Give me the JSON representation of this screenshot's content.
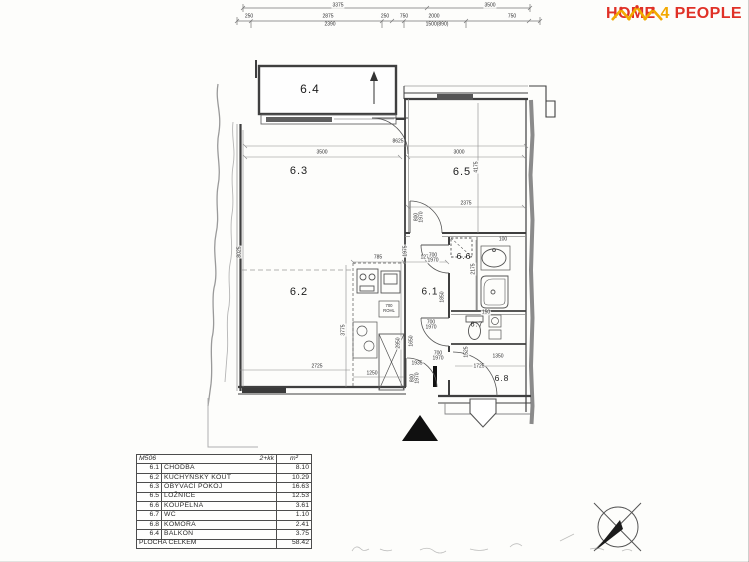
{
  "colors": {
    "logo_red": "#e03127",
    "logo_gold": "#f2a900",
    "wall": "#3f3f3f"
  },
  "logo": {
    "home": "HOME",
    "four": "4",
    "people": "PEOPLE"
  },
  "plan": {
    "rooms": [
      {
        "id": "6.4",
        "x": 310,
        "y": 89,
        "fs": 12
      },
      {
        "id": "6.3",
        "x": 299,
        "y": 171,
        "fs": 11
      },
      {
        "id": "6.2",
        "x": 299,
        "y": 292,
        "fs": 11
      },
      {
        "id": "6.5",
        "x": 462,
        "y": 172,
        "fs": 11
      },
      {
        "id": "6.1",
        "x": 430,
        "y": 292,
        "fs": 10
      },
      {
        "id": "6.6",
        "x": 464,
        "y": 256,
        "fs": 8.5
      },
      {
        "id": "6.7",
        "x": 477,
        "y": 325,
        "fs": 7
      },
      {
        "id": "6.8",
        "x": 502,
        "y": 378,
        "fs": 8.5
      }
    ],
    "dimension_labels": [
      {
        "t": "3375",
        "x": 338,
        "y": 6
      },
      {
        "t": "3500",
        "x": 490,
        "y": 6
      },
      {
        "t": "250",
        "x": 249,
        "y": 17
      },
      {
        "t": "2875",
        "x": 328,
        "y": 17
      },
      {
        "t": "250",
        "x": 385,
        "y": 17
      },
      {
        "t": "750",
        "x": 404,
        "y": 17
      },
      {
        "t": "2000",
        "x": 434,
        "y": 17
      },
      {
        "t": "750",
        "x": 512,
        "y": 17
      },
      {
        "t": "2390",
        "x": 330,
        "y": 25
      },
      {
        "t": "1500(890)",
        "x": 437,
        "y": 25
      },
      {
        "t": "8625",
        "x": 398,
        "y": 142
      },
      {
        "t": "3500",
        "x": 322,
        "y": 153
      },
      {
        "t": "3000",
        "x": 459,
        "y": 153
      },
      {
        "t": "4175",
        "x": 477,
        "y": 167,
        "rot": 1
      },
      {
        "t": "2375",
        "x": 466,
        "y": 204
      },
      {
        "t": "8025",
        "x": 240,
        "y": 252,
        "rot": 1
      },
      {
        "t": "3775",
        "x": 344,
        "y": 330,
        "rot": 1
      },
      {
        "t": "2950",
        "x": 399,
        "y": 343,
        "rot": 1
      },
      {
        "t": "2725",
        "x": 317,
        "y": 367
      },
      {
        "t": "1250",
        "x": 372,
        "y": 374
      },
      {
        "t": "785",
        "x": 378,
        "y": 258
      },
      {
        "t": "1975",
        "x": 406,
        "y": 251,
        "rot": 1
      },
      {
        "t": "1275",
        "x": 426,
        "y": 258
      },
      {
        "t": "2175",
        "x": 474,
        "y": 269,
        "rot": 1
      },
      {
        "t": "1850",
        "x": 443,
        "y": 297,
        "rot": 1
      },
      {
        "t": "1650",
        "x": 412,
        "y": 341,
        "rot": 1
      },
      {
        "t": "1935",
        "x": 417,
        "y": 364
      },
      {
        "t": "1525",
        "x": 467,
        "y": 352,
        "rot": 1
      },
      {
        "t": "1725",
        "x": 479,
        "y": 367
      },
      {
        "t": "1350",
        "x": 498,
        "y": 357
      },
      {
        "t": "100",
        "x": 503,
        "y": 240
      },
      {
        "t": "150",
        "x": 486,
        "y": 313
      },
      {
        "t": "800",
        "x": 417,
        "y": 217,
        "rot": 1
      },
      {
        "t": "1970",
        "x": 422,
        "y": 217,
        "rot": 1
      },
      {
        "t": "700",
        "x": 433,
        "y": 256
      },
      {
        "t": "1970",
        "x": 433,
        "y": 261
      },
      {
        "t": "700",
        "x": 431,
        "y": 323
      },
      {
        "t": "1970",
        "x": 431,
        "y": 328
      },
      {
        "t": "700",
        "x": 438,
        "y": 354
      },
      {
        "t": "1970",
        "x": 438,
        "y": 359
      },
      {
        "t": "800",
        "x": 413,
        "y": 378,
        "rot": 1
      },
      {
        "t": "1970",
        "x": 418,
        "y": 378,
        "rot": 1
      },
      {
        "t": "700",
        "x": 389,
        "y": 306,
        "fs": 4.2
      },
      {
        "t": "ROHL",
        "x": 389,
        "y": 311,
        "fs": 4.2
      }
    ]
  },
  "table": {
    "header": {
      "unit": "M506",
      "layout": "2+kk",
      "area_unit": "m²"
    },
    "rows": [
      {
        "code": "6.1",
        "name": "CHODBA",
        "area": "8.10"
      },
      {
        "code": "6.2",
        "name": "KUCHYŇSKÝ KOUT",
        "area": "10.29"
      },
      {
        "code": "6.3",
        "name": "OBÝVACÍ POKOJ",
        "area": "16.63"
      },
      {
        "code": "6.5",
        "name": "LOŽNICE",
        "area": "12.53"
      },
      {
        "code": "6.6",
        "name": "KOUPELNA",
        "area": "3.61"
      },
      {
        "code": "6.7",
        "name": "WC",
        "area": "1.10"
      },
      {
        "code": "6.8",
        "name": "KOMORA",
        "area": "2.41"
      },
      {
        "code": "6.4",
        "name": "BALKON",
        "area": "3.75"
      }
    ],
    "footer": {
      "label": "PLOCHA CELKEM",
      "value": "58.42"
    }
  }
}
